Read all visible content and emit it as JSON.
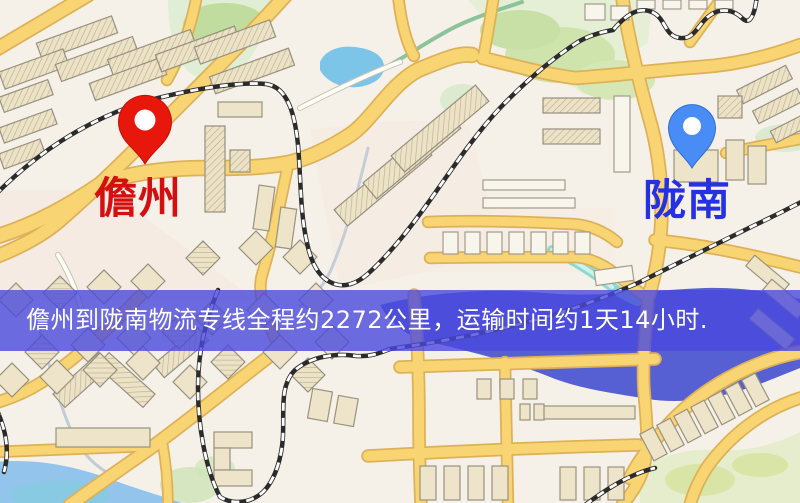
{
  "map": {
    "origin": {
      "label": "儋州",
      "pin_color": "#e8170c",
      "pin_edge": "#c20f08",
      "label_color": "#d40f10"
    },
    "destination": {
      "label": "陇南",
      "pin_color": "#4a8cf5",
      "pin_edge": "#2f6fd6",
      "label_color": "#2531e2"
    }
  },
  "banner": {
    "text": "儋州到陇南物流专线全程约2272公里，运输时间约1天14小时.",
    "bg_color": "#4a48dc",
    "text_color": "#ffffff",
    "route_info": {
      "origin": "儋州",
      "destination": "陇南",
      "distance_km": "2272",
      "duration": "1天14小时"
    }
  },
  "palette": {
    "background": "#f6f1e8",
    "road_fill": "#f8d572",
    "road_casing": "#ddb158",
    "water_lake": "#5760d2",
    "water_pond": "#7cc5e8",
    "water_shore": "#92c4ec",
    "park_green": "#dff0d8",
    "building_fill": "#eee4c9",
    "railway": "#2b2b2b"
  }
}
